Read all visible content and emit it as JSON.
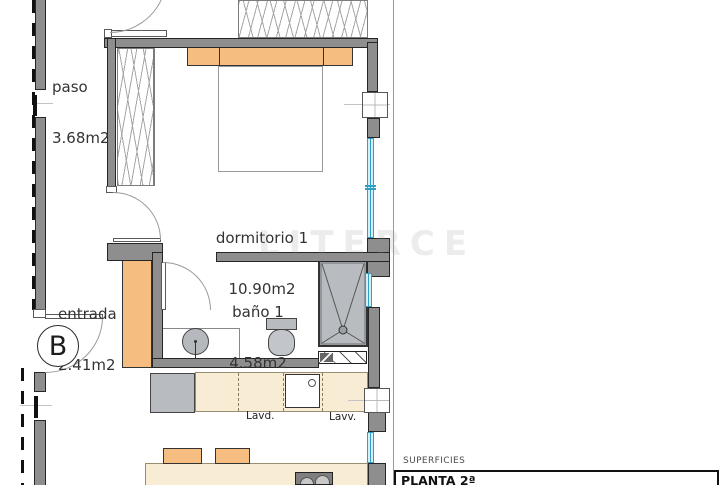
{
  "plan": {
    "rooms": {
      "paso": {
        "name": "paso",
        "area": "3.68m2"
      },
      "dormitorio": {
        "name": "dormitorio 1",
        "area": "10.90m2"
      },
      "entrada": {
        "name": "entrada",
        "area": "2.41m2"
      },
      "bano": {
        "name": "baño 1",
        "area": "4.58m2"
      }
    },
    "appliances": {
      "washer": "Lavd.",
      "dishwasher": "Lavv."
    },
    "marker": "B",
    "watermark": "LITERCE"
  },
  "legend": {
    "superficies": "SUPERFICIES",
    "planta": "PLANTA 2ª"
  },
  "colors": {
    "wall": "#8e8e8e",
    "furniture_orange": "#f6bd80",
    "counter_cream": "#f8ecd5",
    "window_blue": "#2f9fc6",
    "fixture_gray": "#b8bcc0"
  }
}
